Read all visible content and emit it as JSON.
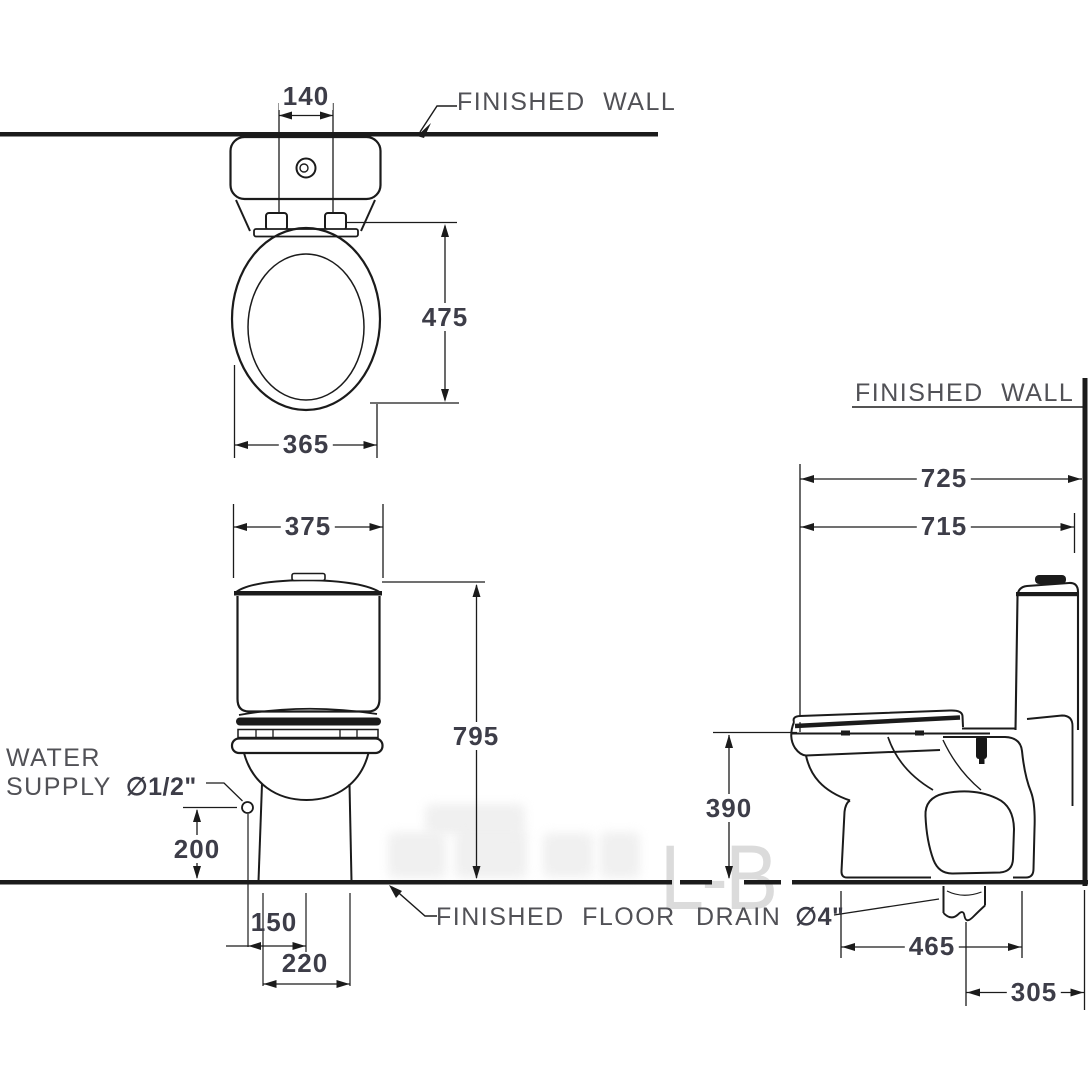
{
  "labels": {
    "finished_wall_top": "FINISHED WALL",
    "finished_wall_right": "FINISHED WALL",
    "finished_floor": "FINISHED FLOOR",
    "water_line1": "WATER",
    "water_line2": "SUPPLY",
    "water_size": "∅1/2\"",
    "drain": "DRAIN",
    "drain_size": "∅4\""
  },
  "dimensions": {
    "cistern_lid_width": "140",
    "seat_length": "475",
    "seat_width": "365",
    "tank_width": "375",
    "total_height": "795",
    "supply_height": "200",
    "supply_to_center": "150",
    "base_width": "220",
    "wall_to_front": "725",
    "overall_depth": "715",
    "rim_height": "390",
    "base_depth": "465",
    "drain_to_wall": "305"
  },
  "watermark": "L-B",
  "colors": {
    "line": "#1b1b1b",
    "dim_text": "#3d3d48",
    "label_text": "#515156",
    "watermark": "#dbdbdb",
    "background": "#ffffff"
  }
}
